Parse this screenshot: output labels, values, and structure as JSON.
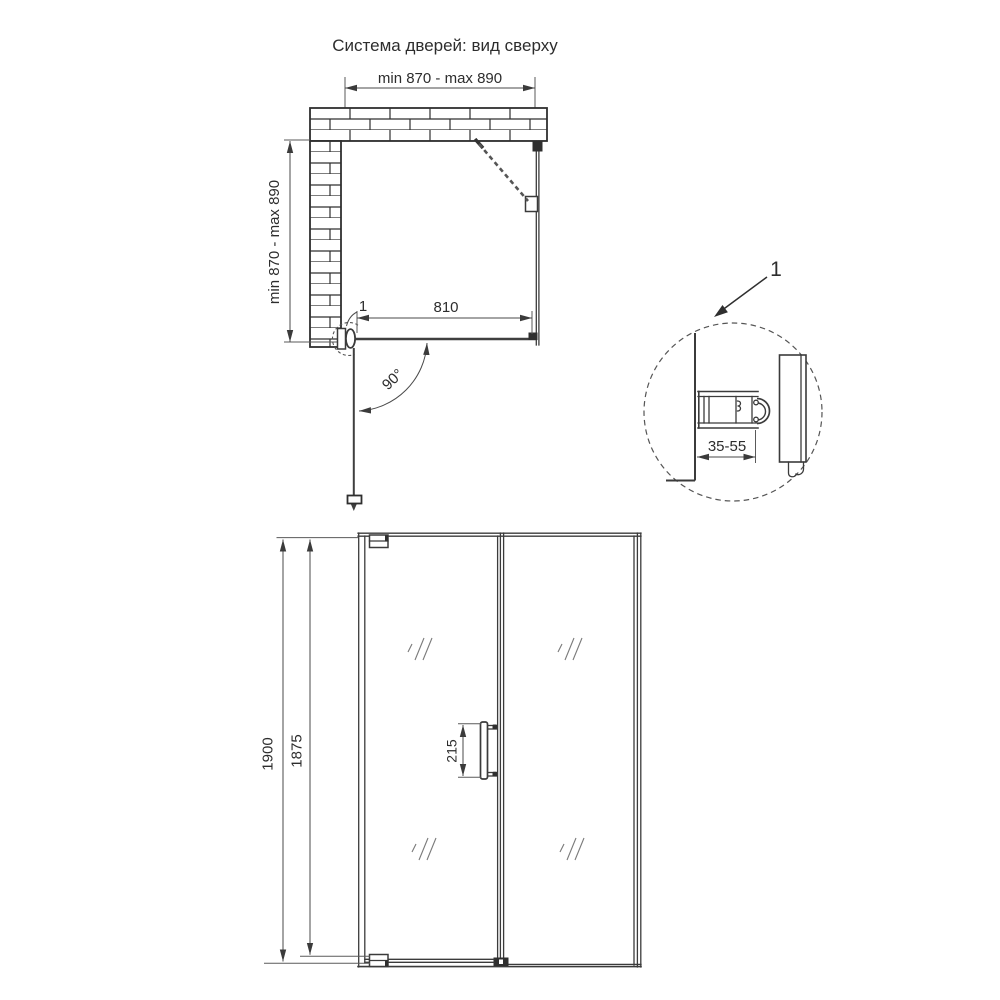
{
  "title": "Система дверей: вид сверху",
  "colors": {
    "background": "#ffffff",
    "line": "#3b3b3b",
    "dimension": "#4a4a4a",
    "text": "#2d2d2d"
  },
  "top_view": {
    "width_dim": "min 870 - max 890",
    "depth_dim": "min 870 - max 890",
    "door_width_dim": "810",
    "swing_angle": "90°",
    "detail_marker": "1"
  },
  "detail_view": {
    "marker": "1",
    "adjustment_dim": "35-55"
  },
  "front_view": {
    "total_height_dim": "1900",
    "glass_height_dim": "1875",
    "handle_length_dim": "215"
  }
}
